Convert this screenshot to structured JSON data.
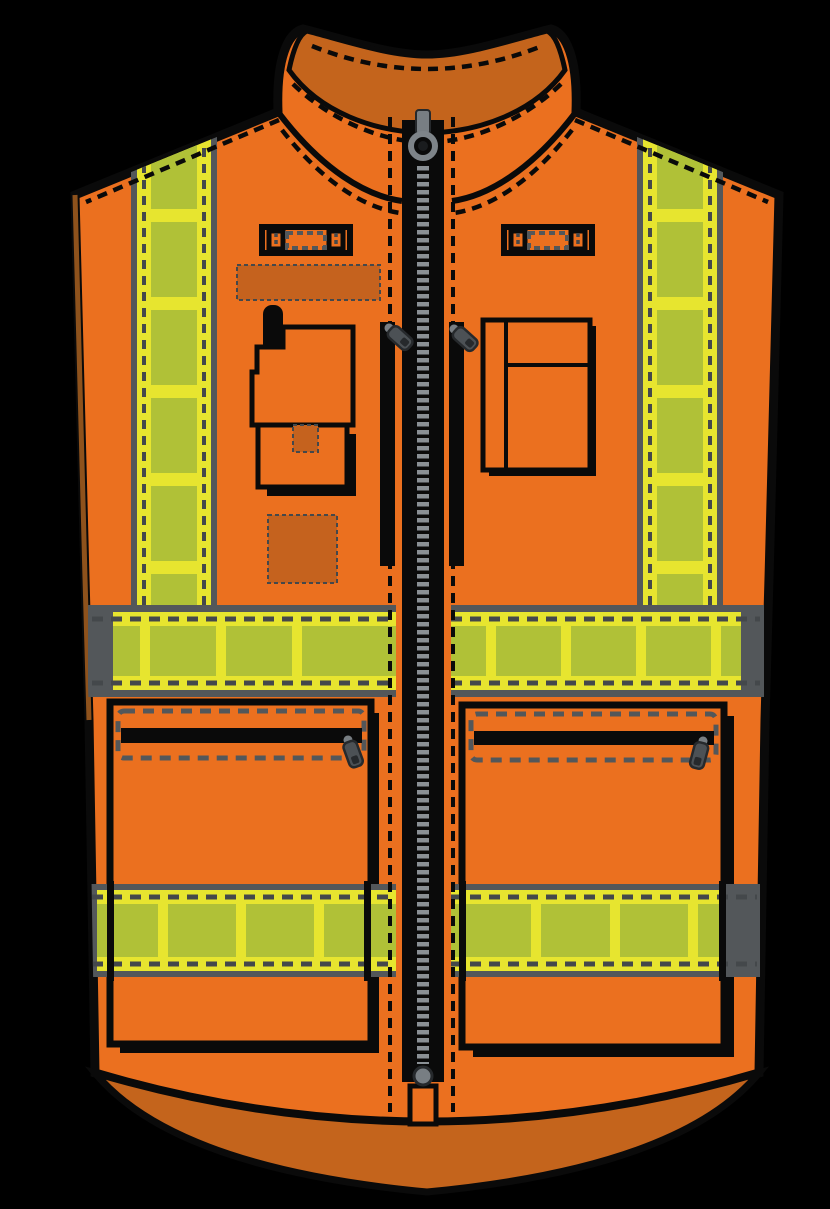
{
  "page": {
    "background": "#000000",
    "description": "Vector illustration of a high-visibility orange safety bodywarmer vest, front view, with yellow reflective bands and black center zipper"
  },
  "colors": {
    "orange": "#EB701F",
    "orange-dark": "#C4641C",
    "orange-panel": "#C5621E",
    "hivis-yellow": "#E7E52F",
    "hivis-olive": "#B0C137",
    "band-gray": "#53575A",
    "stitch-gray": "#44484B",
    "zipper-gray": "#8A9095",
    "zipper-metal": "#787E83",
    "pull-gray": "#4C5155",
    "pull-dark": "#26292C",
    "outline-black": "#0A0A0A"
  },
  "components": {
    "collar": "stand-up collar",
    "main_zipper": "center front zipper with ring pull",
    "chest_loop_left": "left mic loop",
    "chest_loop_right": "right mic loop",
    "badge_panel": "dashed badge panel",
    "radio_pocket": "left radio pocket with antenna",
    "chest_pocket_right": "right chest pocket with pen divider",
    "chest_zip_left": "left vertical chest zip",
    "chest_zip_right": "right vertical chest zip",
    "stripe_left": "left vertical reflective stripe",
    "stripe_right": "right vertical reflective stripe",
    "band_mid": "waist reflective band",
    "band_lower": "lower reflective band",
    "cargo_pocket_left": "left zipped cargo pocket",
    "cargo_pocket_right": "right zipped cargo pocket",
    "hem": "darker orange hem"
  }
}
